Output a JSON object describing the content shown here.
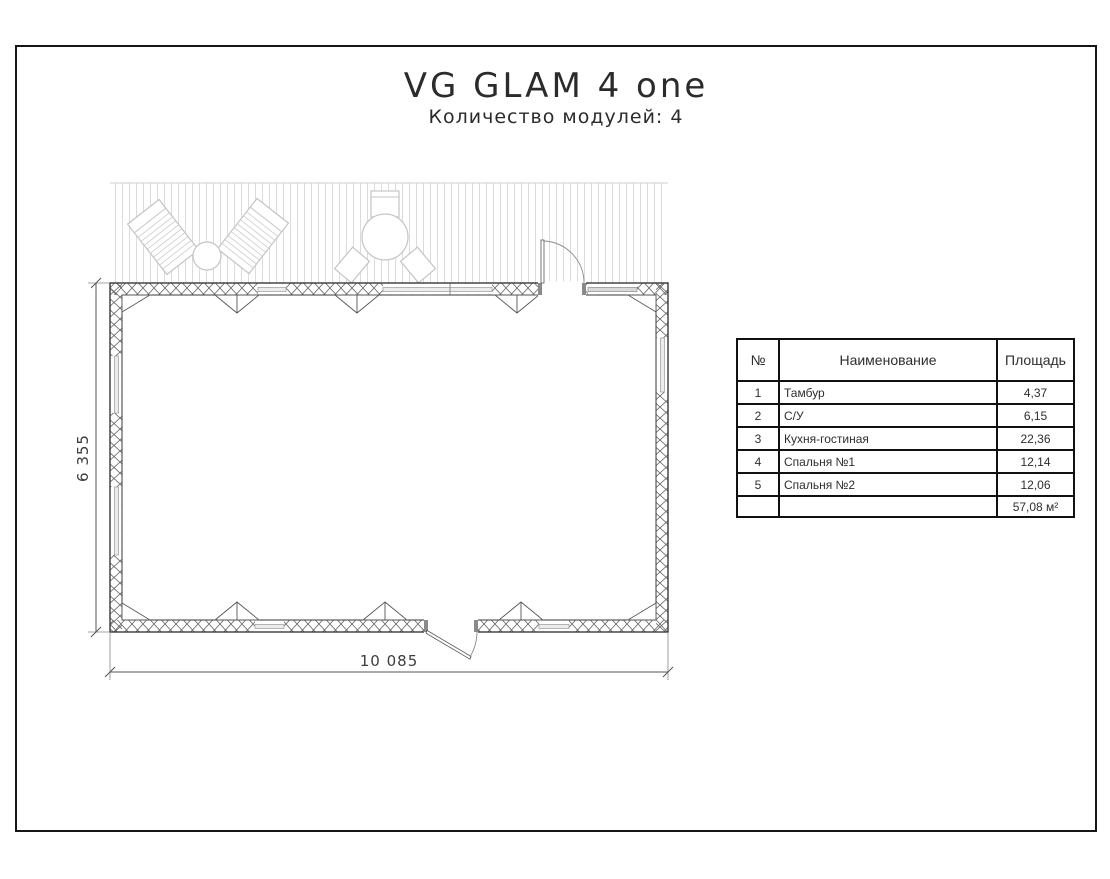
{
  "title": "VG GLAM 4 one",
  "subtitle": "Количество модулей: 4",
  "plan": {
    "dim_width": "10 085",
    "dim_height": "6 355"
  },
  "table": {
    "headers": {
      "num": "№",
      "name": "Наименование",
      "area": "Площадь"
    },
    "rows": [
      {
        "num": "1",
        "name": "Тамбур",
        "area": "4,37"
      },
      {
        "num": "2",
        "name": "С/У",
        "area": "6,15"
      },
      {
        "num": "3",
        "name": "Кухня-гостиная",
        "area": "22,36"
      },
      {
        "num": "4",
        "name": "Спальня №1",
        "area": "12,14"
      },
      {
        "num": "5",
        "name": "Спальня №2",
        "area": "12,06"
      }
    ],
    "total_area": "57,08 м²"
  }
}
